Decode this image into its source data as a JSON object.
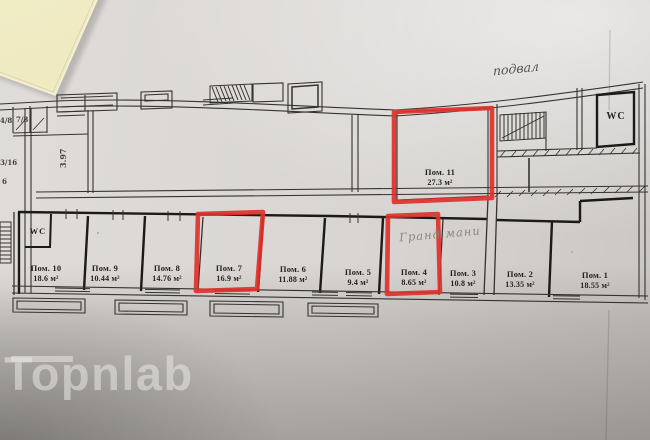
{
  "annotations": {
    "floor_label": "подвал",
    "handwritten_note": "Гранд мани"
  },
  "plan": {
    "room_11": {
      "name": "Пом. 11",
      "area": "27.3 м²"
    },
    "wc_upper": "WC",
    "wc_lower": "WC",
    "bottom_rooms": [
      {
        "name": "Пом. 10",
        "area": "18.6 м²"
      },
      {
        "name": "Пом. 9",
        "area": "10.44 м²"
      },
      {
        "name": "Пом. 8",
        "area": "14.76 м²"
      },
      {
        "name": "Пом. 7",
        "area": "16.9 м²"
      },
      {
        "name": "Пом. 6",
        "area": "11.88 м²"
      },
      {
        "name": "Пом. 5",
        "area": "9.4 м²"
      },
      {
        "name": "Пом. 4",
        "area": "8.65 м²"
      },
      {
        "name": "Пом. 3",
        "area": "10.8 м²"
      },
      {
        "name": "Пом. 2",
        "area": "13.35 м²"
      },
      {
        "name": "Пом. 1",
        "area": "18.55 м²"
      }
    ],
    "highlighted_rooms": [
      "Пом. 11",
      "Пом. 7",
      "Пом. 4"
    ],
    "dimensions": {
      "height_left": "3.97",
      "frac_a": "4/8",
      "frac_b": "7/8",
      "frac_c": "3/16",
      "frac_d": "6"
    }
  },
  "watermark": "Topnlab",
  "colors": {
    "highlight": "#e0312b",
    "sticky-note": "#efeac1",
    "paper": "#d8d5d2",
    "ink": "#35332f"
  }
}
